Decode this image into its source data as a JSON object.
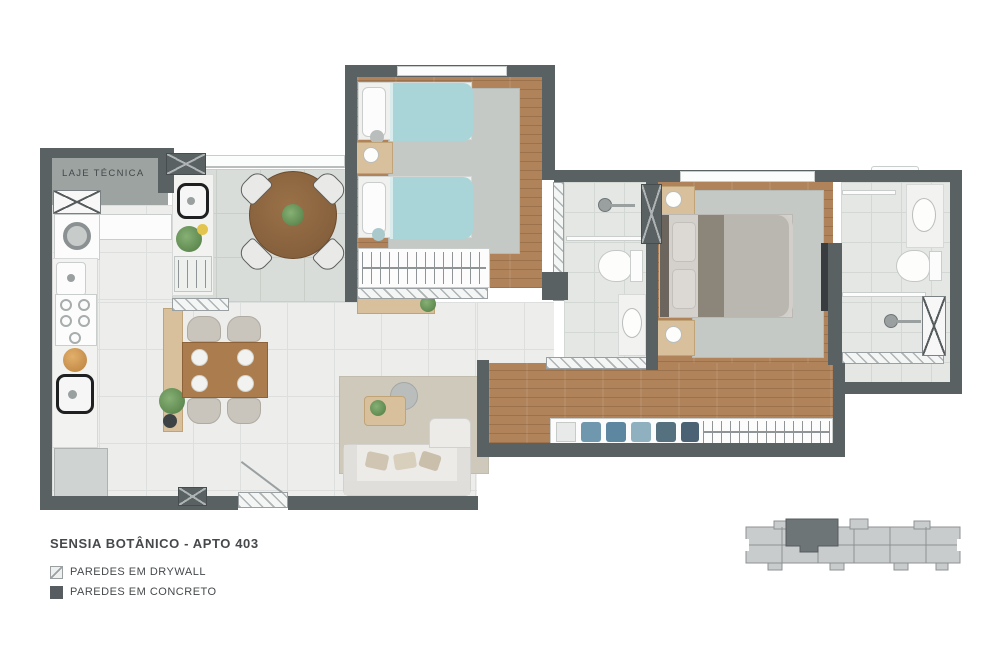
{
  "title": "SENSIA BOTÂNICO - APTO 403",
  "plan_labels": {
    "laje_tecnica": "LAJE TÉCNICA"
  },
  "legend": {
    "items": [
      {
        "label": "PAREDES EM DRYWALL",
        "swatch": "drywall"
      },
      {
        "label": "PAREDES EM CONCRETO",
        "swatch": "concrete"
      }
    ]
  },
  "colors": {
    "wall": "#5a6163",
    "wood": "#b0835a",
    "tile": "#edeeec",
    "teal": "#a9d5d8",
    "concrete": "#9da3a1",
    "ink": "#45494c",
    "keyplan_light": "#c9cccd",
    "keyplan_dark": "#6e7577"
  },
  "keyplan": {
    "description": "building-footprint-with-unit-403-highlighted"
  }
}
